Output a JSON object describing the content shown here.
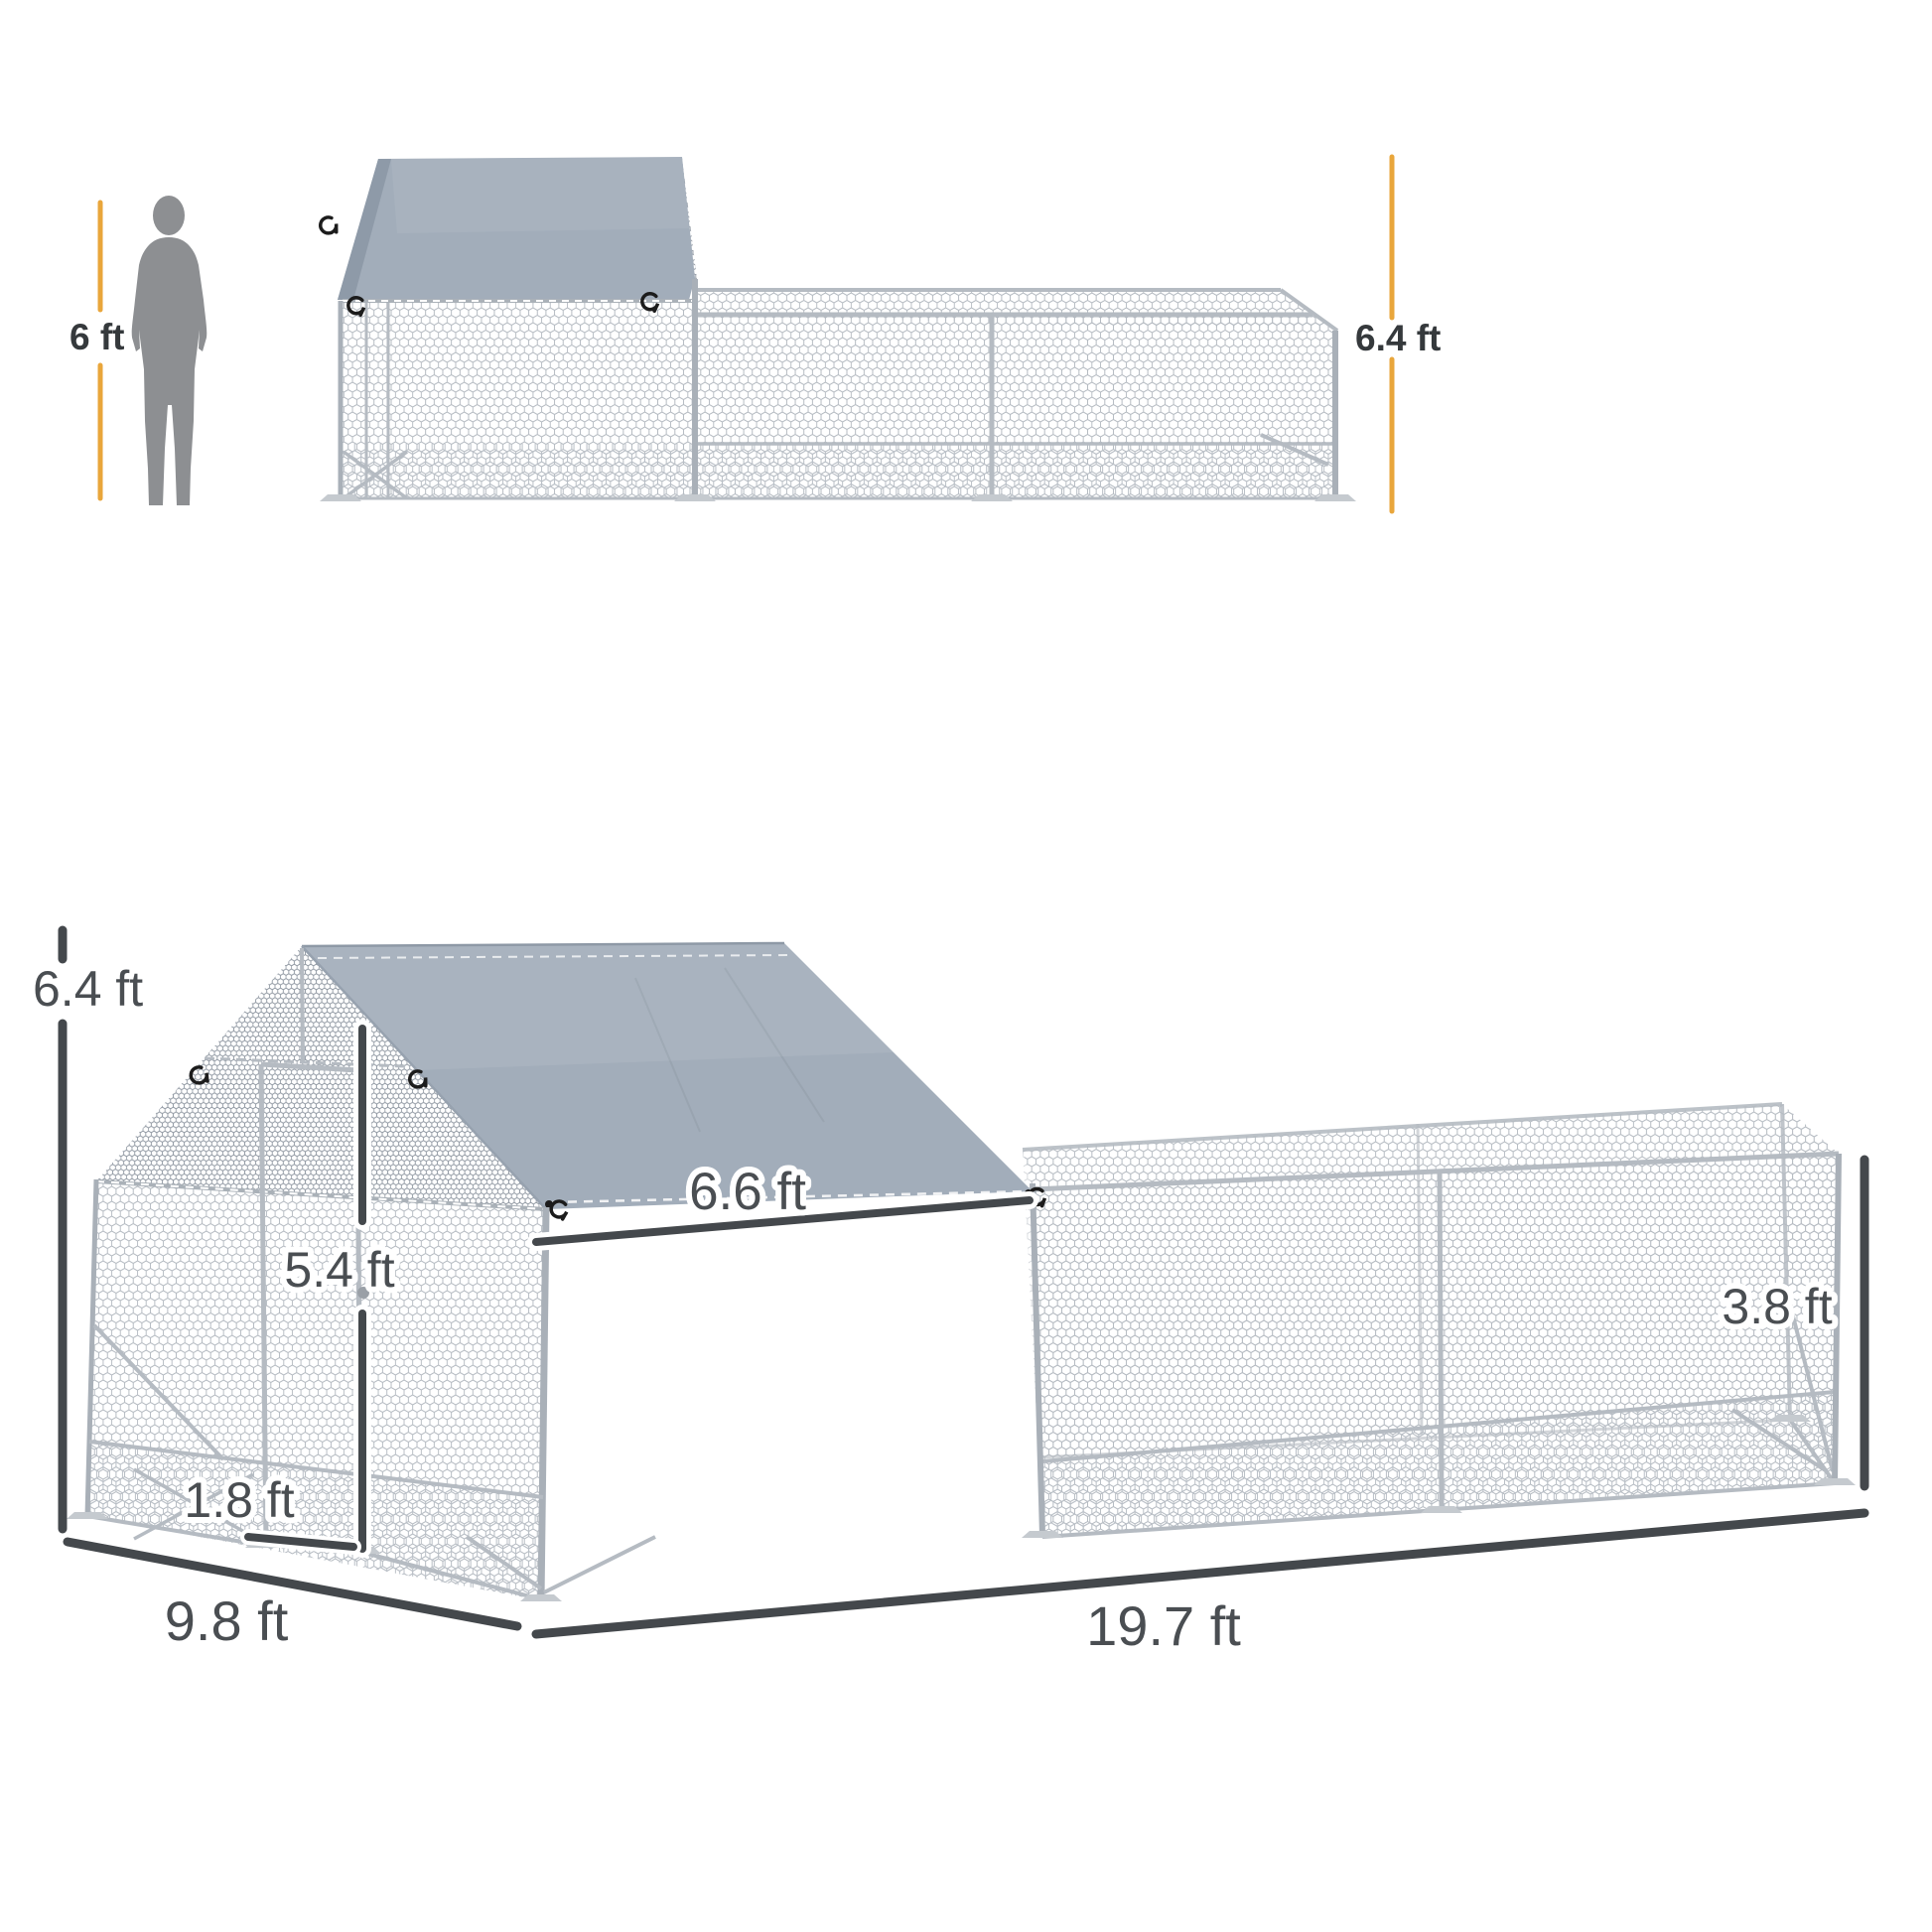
{
  "side_view": {
    "human_height_label": "6 ft",
    "peak_height_label": "6.4 ft"
  },
  "perspective_view": {
    "peak_height_label": "6.4 ft",
    "door_height_label": "5.4 ft",
    "covered_roof_length_label": "6.6 ft",
    "run_height_label": "3.8 ft",
    "apron_height_label": "1.8 ft",
    "width_label": "9.8 ft",
    "length_label": "19.7 ft"
  },
  "colors": {
    "dimension_accent": "#E9A63B",
    "dimension_dark": "#44484C",
    "tarp_gray": "#A2ADBA",
    "text_dark": "#35393C",
    "text_gray": "#4A4E52",
    "silhouette_gray": "#8D8F92"
  }
}
